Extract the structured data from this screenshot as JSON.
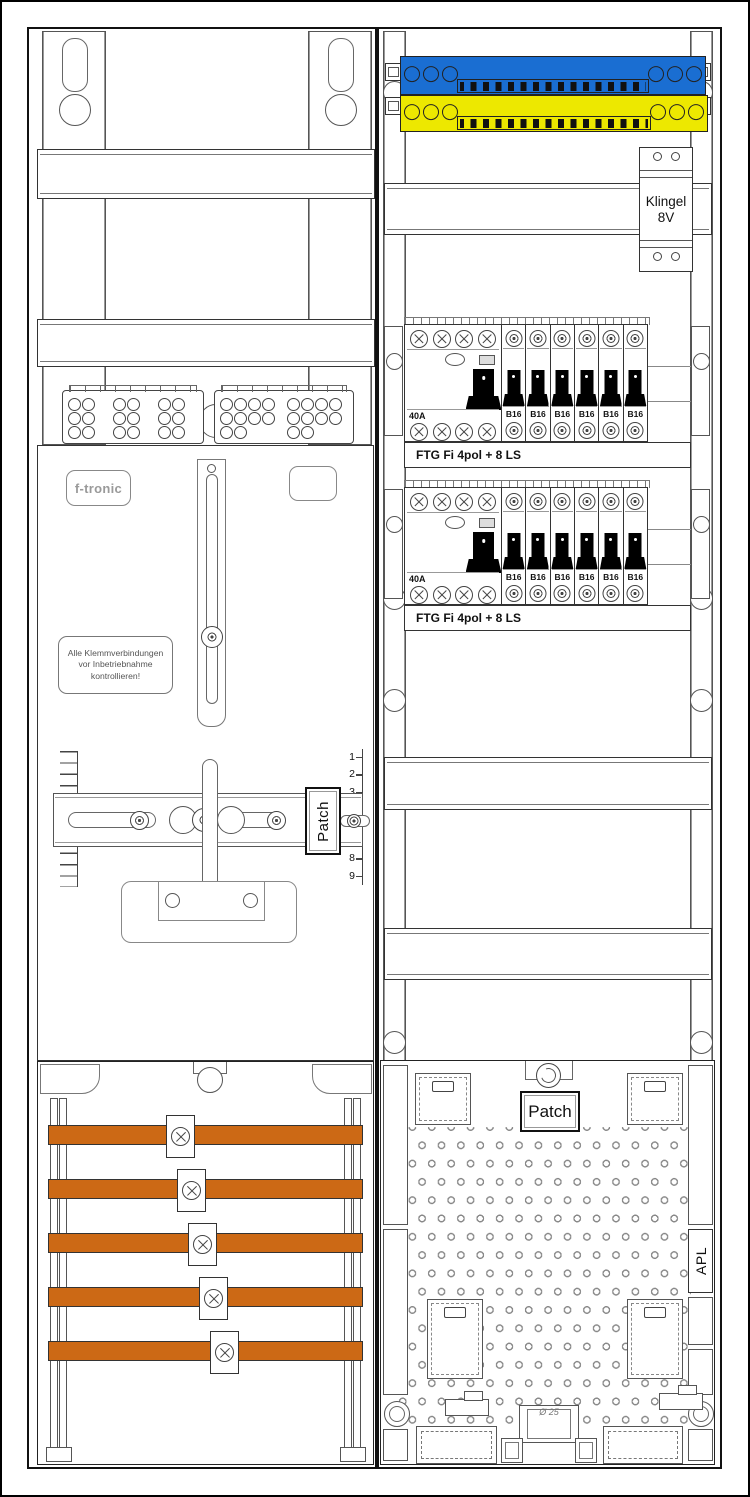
{
  "colors": {
    "busbar_blue": "#1a6ed2",
    "busbar_yellow": "#ede800",
    "wiring_duct_orange": "#cc6915"
  },
  "left_column": {
    "brand_label": "f-tronic",
    "warning_label_lines": [
      "Alle Klemmverbindungen",
      "vor Inbetriebnahme",
      "kontrollieren!"
    ],
    "patch_label": "Patch",
    "ruler_numbers_top": [
      "1",
      "2",
      "3"
    ],
    "ruler_numbers_bottom": [
      "7",
      "8",
      "9"
    ],
    "wiring_bars_count": 5
  },
  "right_column": {
    "bell_transformer": {
      "line1": "Klingel",
      "line2": "8V"
    },
    "breaker_rows": [
      {
        "rcd_rating": "40A",
        "mcb_labels": [
          "B16",
          "B16",
          "B16",
          "B16",
          "B16",
          "B16"
        ],
        "strip_label": "FTG Fi 4pol + 8 LS"
      },
      {
        "rcd_rating": "40A",
        "mcb_labels": [
          "B16",
          "B16",
          "B16",
          "B16",
          "B16",
          "B16"
        ],
        "strip_label": "FTG Fi 4pol + 8 LS"
      }
    ],
    "patch_label": "Patch",
    "apl_label": "APL",
    "knockout_diameter_label": "Ø 25"
  }
}
